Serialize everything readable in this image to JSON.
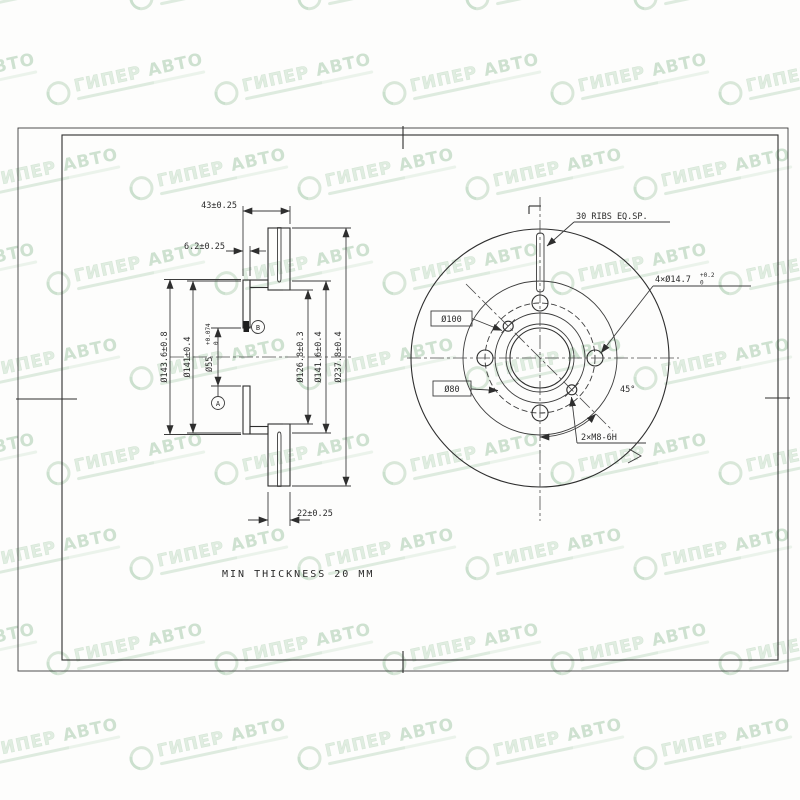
{
  "watermark": {
    "brand_primary": "ГИПЕР",
    "brand_secondary": "АВТО"
  },
  "section_view": {
    "dims": {
      "overall_width": "43±0.25",
      "hat_face_thickness": "6.2±0.25",
      "ring_thickness": "22±0.25",
      "flange_od": "Ø143.6±0.8",
      "flange_d": "Ø141±0.4",
      "bore": {
        "main": "Ø55",
        "tol_up": "+0.074",
        "tol_dn": "0"
      },
      "vent_id": "Ø126.8±0.3",
      "ring_id": "Ø141.6±0.4",
      "disc_od": "Ø237.8±0.4"
    },
    "balloons": {
      "upper": "B",
      "lower": "A"
    }
  },
  "front_view": {
    "labels": {
      "ribs_note": "30 RIBS EQ.SP.",
      "bolt_holes": {
        "main": "4×Ø14.7",
        "tol_up": "+0.2",
        "tol_dn": "0"
      },
      "pcd": "Ø100",
      "register": "Ø80",
      "service_holes": "2×M8-6H",
      "angle": "45°"
    }
  },
  "notes": {
    "min_thickness": "MIN THICKNESS 20 MM"
  }
}
